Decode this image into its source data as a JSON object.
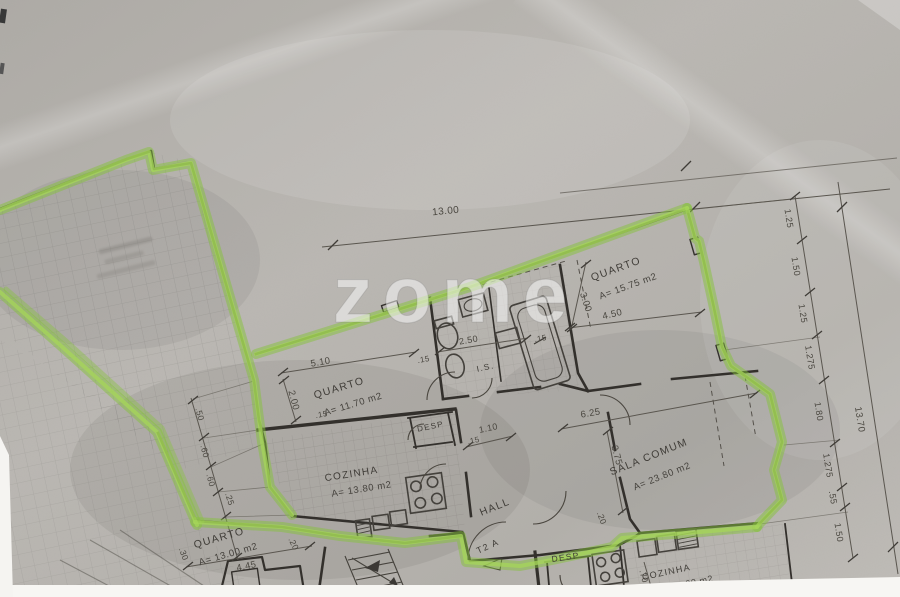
{
  "scan": {
    "watermark": "zome",
    "apartment_type": "T2 A"
  },
  "colors": {
    "highlighter_green": "#8cc63f",
    "paper_gray": "#b6b3ae",
    "ink": "#3b3834"
  },
  "rooms": [
    {
      "name": "QUARTO",
      "area": "A= 15.75 m2"
    },
    {
      "name": "QUARTO",
      "area": "A= 11.70 m2"
    },
    {
      "name": "SALA COMUM",
      "area": "A= 23.80 m2"
    },
    {
      "name": "COZINHA",
      "area": "A= 13.80 m2"
    },
    {
      "name": "QUARTO",
      "area": "A= 13.00 m2"
    },
    {
      "name": "HALL",
      "area": ""
    },
    {
      "name": "I.S.",
      "area": ""
    },
    {
      "name": "DESP",
      "area": ""
    },
    {
      "name": "DESP",
      "area": ""
    },
    {
      "name": "COZINHA",
      "area": "00 m2"
    }
  ],
  "dimensions": {
    "top_width": "13.00",
    "right_total": "13.70",
    "right_chain": [
      "1.25",
      "1.50",
      "1.25",
      "1.275",
      "1.80",
      "1.275",
      ".55",
      "1.50"
    ],
    "left_chain": [
      ".50",
      ".60",
      ".60",
      ".25"
    ],
    "quarto_top_width": "4.50",
    "quarto_top_height": "3.00",
    "quarto_mid_width": "5.10",
    "quarto_mid_height": "2.00",
    "bath_width": "2.50",
    "hall_width": "1.10",
    "sala_width": "6.25",
    "sala_height": "3.75",
    "quarto_bottom_width": "4.45",
    "wall_15_a": ".15",
    "wall_15_b": ".15",
    "wall_15_c": ".15",
    "wall_15_d": ".15",
    "offset_30": ".30",
    "offset_20_a": ".20",
    "offset_20_b": ".20",
    "offset_70": ".70"
  }
}
